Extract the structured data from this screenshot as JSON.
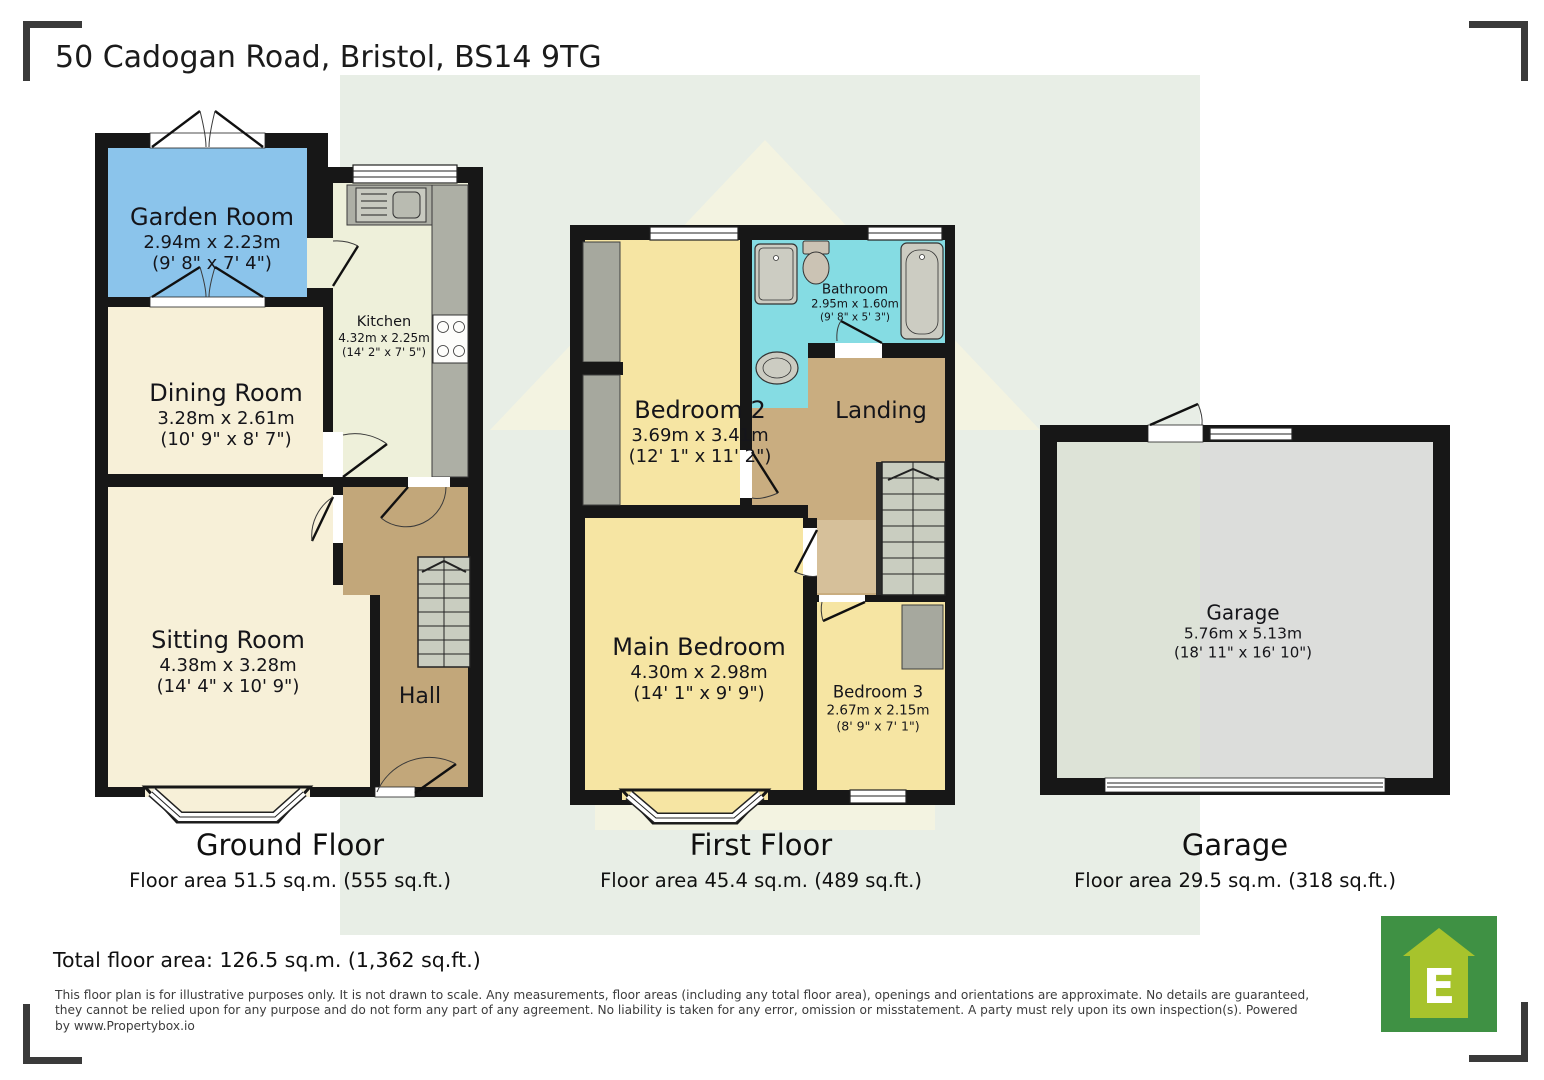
{
  "title": "50 Cadogan Road, Bristol, BS14 9TG",
  "floors": {
    "ground": {
      "caption": {
        "name": "Ground Floor",
        "area": "Floor area 51.5 sq.m. (555 sq.ft.)"
      },
      "rooms": {
        "garden_room": {
          "name": "Garden Room",
          "metric": "2.94m x 2.23m",
          "imperial": "(9' 8\" x 7' 4\")"
        },
        "kitchen": {
          "name": "Kitchen",
          "metric": "4.32m x 2.25m",
          "imperial": "(14' 2\" x 7' 5\")"
        },
        "dining_room": {
          "name": "Dining Room",
          "metric": "3.28m x 2.61m",
          "imperial": "(10' 9\" x 8' 7\")"
        },
        "sitting_room": {
          "name": "Sitting Room",
          "metric": "4.38m x 3.28m",
          "imperial": "(14' 4\" x 10' 9\")"
        },
        "hall": {
          "name": "Hall"
        }
      }
    },
    "first": {
      "caption": {
        "name": "First Floor",
        "area": "Floor area 45.4 sq.m. (489 sq.ft.)"
      },
      "rooms": {
        "bedroom_2": {
          "name": "Bedroom 2",
          "metric": "3.69m x 3.41m",
          "imperial": "(12' 1\" x 11' 2\")"
        },
        "bathroom": {
          "name": "Bathroom",
          "metric": "2.95m x 1.60m",
          "imperial": "(9' 8\" x 5' 3\")"
        },
        "landing": {
          "name": "Landing"
        },
        "main_bedroom": {
          "name": "Main Bedroom",
          "metric": "4.30m x 2.98m",
          "imperial": "(14' 1\" x 9' 9\")"
        },
        "bedroom_3": {
          "name": "Bedroom 3",
          "metric": "2.67m x 2.15m",
          "imperial": "(8' 9\" x 7' 1\")"
        }
      }
    },
    "garage": {
      "caption": {
        "name": "Garage",
        "area": "Floor area 29.5 sq.m. (318 sq.ft.)"
      },
      "rooms": {
        "garage": {
          "name": "Garage",
          "metric": "5.76m x 5.13m",
          "imperial": "(18' 11\" x 16' 10\")"
        }
      }
    }
  },
  "total_area": "Total floor area: 126.5 sq.m. (1,362 sq.ft.)",
  "disclaimer": {
    "line1": "This floor plan is for illustrative purposes only. It is not drawn to scale. Any measurements, floor areas (including any total floor area), openings and orientations are approximate. No details are guaranteed,",
    "line2": "they cannot be relied upon for any purpose and do not form any part of any agreement. No liability is taken for any error, omission or misstatement. A party must rely upon its own inspection(s). Powered",
    "line3": "by www.Propertybox.io"
  },
  "logo": {
    "letter": "E"
  },
  "colors": {
    "garden_room_blue": "#8bc4eb",
    "bedroom_yellow": "#f6e5a3",
    "bathroom_cyan": "#85dce3",
    "hall_tan": "#c2a77a",
    "landing_tan": "#c9ad80",
    "cream": "#f7f0d8",
    "kitchen_floor": "#eef0da",
    "garage_gray": "#dcdddb",
    "wall_black": "#171717",
    "watermark_band": "#e8eee6",
    "logo_green": "#3f9144",
    "logo_house_green": "#a7c32c"
  }
}
